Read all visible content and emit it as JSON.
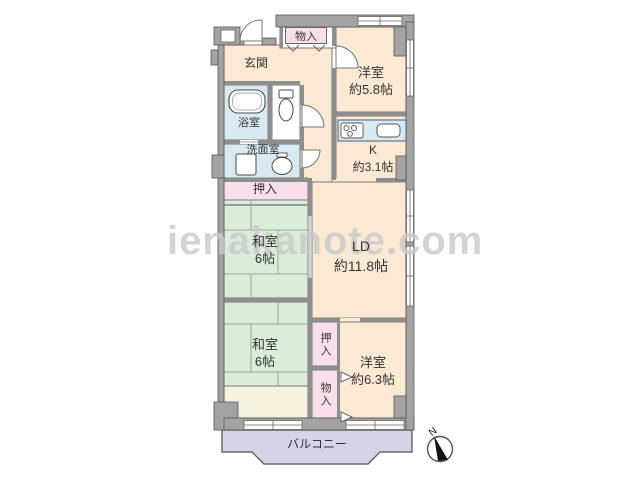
{
  "watermark": {
    "text": "ienakanote.com"
  },
  "compass": {
    "label": "N"
  },
  "rooms": {
    "entrance": {
      "label": "玄関"
    },
    "storage_top": {
      "label": "物入"
    },
    "western_room_1": {
      "label": "洋室",
      "size": "約5.8帖"
    },
    "bathroom": {
      "label": "浴室"
    },
    "washroom": {
      "label": "洗面室"
    },
    "kitchen": {
      "label": "K",
      "size": "約3.1帖"
    },
    "closet_left": {
      "label": "押入"
    },
    "japanese_room_1": {
      "label": "和室",
      "size": "6帖"
    },
    "living_dining": {
      "label": "LD",
      "size": "約11.8帖"
    },
    "japanese_room_2": {
      "label": "和室",
      "size": "6帖"
    },
    "closet_right": {
      "label": "押入"
    },
    "storage_right": {
      "label": "物入"
    },
    "western_room_2": {
      "label": "洋室",
      "size": "約6.3帖"
    },
    "balcony": {
      "label": "バルコニー"
    }
  },
  "colors": {
    "room": "#fbe9d3",
    "tatami": "#dcecdb",
    "closet": "#f8dfe9",
    "wet": "#d9e9f1",
    "balcony": "#d6d3e7",
    "floorstrip": "#f5f2dd",
    "wall": "#a3a3a3",
    "walledge": "#565656",
    "line": "#7a7a7a",
    "watermark": "#c9c9c9",
    "text": "#333333"
  }
}
